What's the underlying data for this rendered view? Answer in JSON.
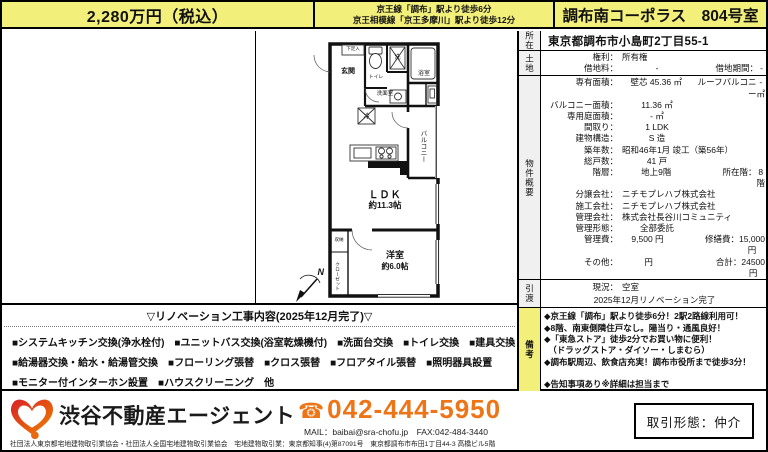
{
  "colors": {
    "yellow": "#f2ef7b",
    "orange": "#ee7517",
    "section_gray": "#f0f0f0"
  },
  "header": {
    "price": "2,280万円（税込）",
    "access_line1": "京王線「調布」駅より徒歩6分",
    "access_line2": "京王相模線「京王多摩川」駅より徒歩12分",
    "title": "調布南コーポラス　804号室"
  },
  "plan": {
    "labels": {
      "geta": "下足入",
      "genkan": "玄関",
      "toilet": "トイレ",
      "washer": "洗",
      "bath": "浴室",
      "washroom": "洗面室",
      "fridge": "冷",
      "balcony": "バルコニー",
      "ldk": "ＬＤＫ",
      "ldk_size": "約11.3帖",
      "bedroom": "洋室",
      "bedroom_size": "約6.0帖",
      "closet": "クローゼット",
      "storage": "収納",
      "north": "N"
    }
  },
  "reno": {
    "title": "▽リノベーション工事内容(2025年12月完了)▽",
    "lines": [
      "■システムキッチン交換(浄水栓付)　■ユニットバス交換(浴室乾燥機付)　■洗面台交換　■トイレ交換　■建具交換",
      "■給湯器交換・給水・給湯管交換　■フローリング張替　■クロス張替　■フロアタイル張替　■照明器具設置",
      "■モニター付インターホン設置　■ハウスクリーニング　他"
    ]
  },
  "table": {
    "section_labels": {
      "location": "所在",
      "land": "土地",
      "overview": "物件概要",
      "handover": "引渡",
      "remarks": "備考"
    },
    "address": "東京都調布市小島町2丁目55-1",
    "land_rows": [
      {
        "k": "権利：",
        "v": "所有権"
      },
      {
        "k": "借地料：",
        "v": "-",
        "k2": "借地期間：",
        "v2": "-"
      }
    ],
    "overview_rows": [
      {
        "k": "専有面積：",
        "v": "壁芯 45.36 ㎡",
        "k2": "ルーフバルコニー",
        "v2": "- ㎡"
      },
      {
        "k": "バルコニー面積：",
        "v": "11.36 ㎡"
      },
      {
        "k": "専用庭面積：",
        "v": "- ㎡"
      },
      {
        "k": "間取り：",
        "v": "1 LDK"
      },
      {
        "k": "建物構造：",
        "v": "S 造"
      },
      {
        "k": "築年数：",
        "v": "昭和46年1月 竣工（築56年）"
      },
      {
        "k": "総戸数：",
        "v": "41 戸"
      },
      {
        "k": "階層：",
        "v": "地上9階",
        "k2": "所在階：",
        "v2": "8階"
      },
      {
        "k": "分譲会社：",
        "v": "ニチモプレハブ株式会社"
      },
      {
        "k": "施工会社：",
        "v": "ニチモプレハブ株式会社"
      },
      {
        "k": "管理会社：",
        "v": "株式会社長谷川コミュニティ"
      },
      {
        "k": "管理形態：",
        "v": "全部委託"
      },
      {
        "k": "管理費：",
        "v": "9,500 円",
        "k2": "修繕費：",
        "v2": "15,000 円"
      },
      {
        "k": "その他：",
        "v": "円",
        "k2": "合計：",
        "v2": "24500 円"
      },
      {
        "k": "駐車場：",
        "v": "-"
      },
      {
        "k": "駐輪場：",
        "v": "-",
        "k2": "バイク置場：",
        "v2": "-"
      },
      {
        "k": "ペット：",
        "v": "不可",
        "k2": "宅配ボックス：",
        "v2": "-"
      },
      {
        "k": "エレベーター：",
        "v": "有",
        "k2": "オートロック：",
        "v2": "-"
      }
    ],
    "handover": {
      "k": "現況：",
      "v": "空室",
      "line2": "2025年12月リノベーション完了"
    },
    "remarks_lines": [
      "◆京王線「調布」駅より徒歩6分！2駅2路線利用可！",
      "◆8階、南東側隣住戸なし。陽当り・通風良好！",
      "◆「東急ストア」徒歩2分でお買い物に便利！",
      "　（ドラッグストア・ダイソー・しまむら）",
      "◆調布駅周辺、飲食店充実！調布市役所まで徒歩3分！",
      "",
      "◆告知事項あり※詳細は担当まで"
    ]
  },
  "footer": {
    "company": "渋谷不動産エージェント",
    "phone_icon": "☎",
    "phone": "042-444-5950",
    "mail_fax": "MAIL：baibai@sra-chofu.jp　FAX:042-484-3440",
    "fine_print": "社団法人東京都宅地建物取引業協会・社団法人全国宅地建物取引業協会　宅地建物取引業：東京都知事(4)第87091号　東京都調布市布田1丁目44-3 高橋ビル5階",
    "deal_type": "取引形態：仲介"
  }
}
